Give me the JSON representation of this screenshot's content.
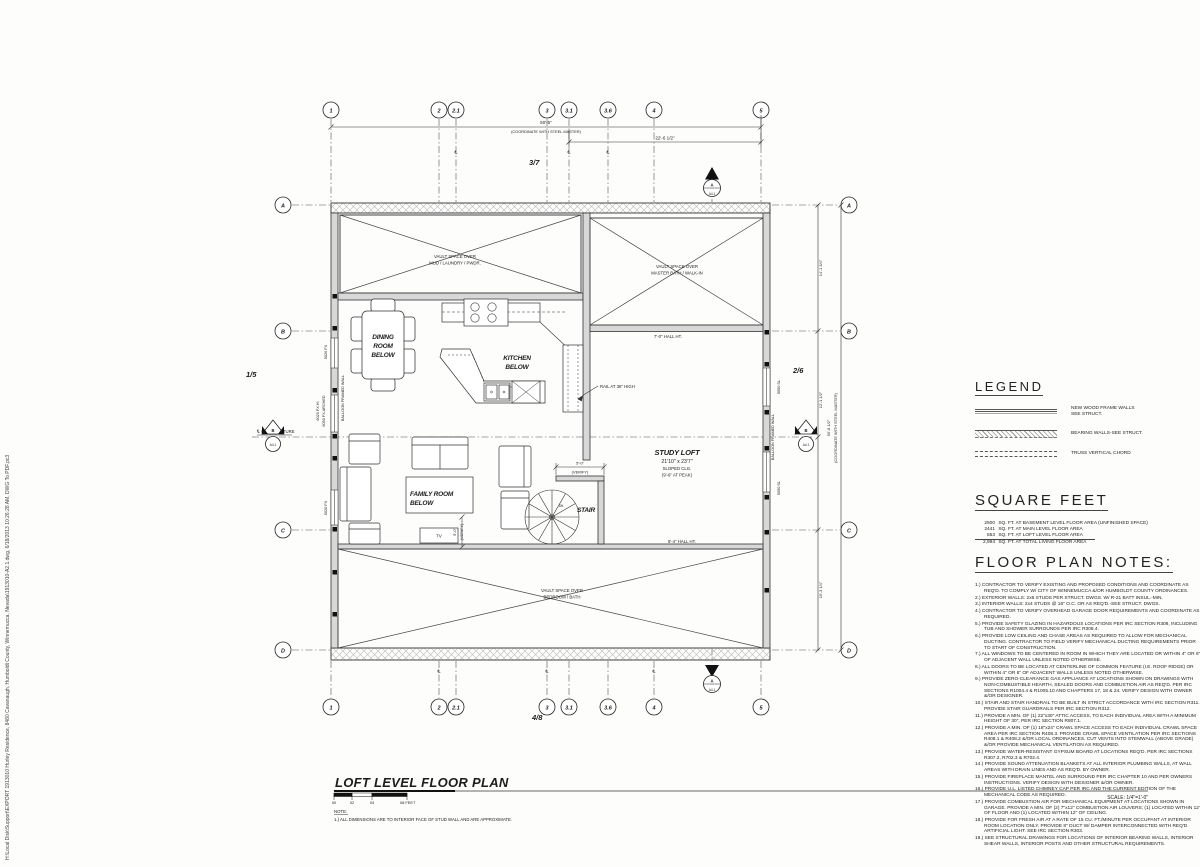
{
  "drawing": {
    "title": "LOFT LEVEL FLOOR PLAN",
    "scale_label": "SCALE: 1/4\"=1'-0\"",
    "scale_bar": [
      "00",
      "02",
      "04",
      "08 FEET"
    ],
    "note_heading": "NOTE:",
    "note_1": "1.)  ALL DIMENSIONS ARE TO INTERIOR FACE OF STUD WALL AND ARE APPROXIMATE.",
    "file_path": "H:\\Local Disk\\Support\\EXPORT 1913010 Hurley Residence, 8480 Cavanaugh, Humboldt County, Winnemucca, Nevada\\1913010-A2.1.dwg, 6/18/2013 10:26:28 AM, DWG To PDF.pc3"
  },
  "grid": {
    "columns": [
      "1",
      "2",
      "2.1",
      "3",
      "3.1",
      "3.6",
      "4",
      "5"
    ],
    "rows": [
      "A",
      "B",
      "C",
      "D"
    ]
  },
  "dims": {
    "top_total": "50'-5\"",
    "steel_note": "(COORDINATE WITH STEEL MASTER)",
    "top_partial": "22'-6 1/2\"",
    "right_total": "50'-8 1/2\"",
    "right_ab": "14'-1 3/4\"",
    "right_bc": "12'-1 1/2\"",
    "right_cd": "10'-3 1/4\"",
    "stair_w": "5'-0\"",
    "verify": "(VERIFY)",
    "cl": "℄",
    "cl_structure": "℄ OF STRUCTURE"
  },
  "refs": {
    "left": "1/5",
    "right": "2/6",
    "top": "3/7",
    "bottom": "4/8",
    "marker_a": "A",
    "marker_b": "B",
    "sheet": "A4.1"
  },
  "rooms": {
    "vault_mud": [
      "VAULT SPACE OVER",
      "MUD / LAUNDRY / PWDR."
    ],
    "vault_master": [
      "VAULT SPACE OVER",
      "MASTER BATH / WALK-IN"
    ],
    "vault_bedroom": [
      "VAULT SPACE OVER",
      "BEDROOM / BATH"
    ],
    "dining": [
      "DINING",
      "ROOM",
      "BELOW"
    ],
    "kitchen": [
      "KITCHEN",
      "BELOW"
    ],
    "family": [
      "FAMILY ROOM",
      "BELOW"
    ],
    "study": [
      "STUDY LOFT",
      "21'10\" x 23'7\"",
      "SLOPED CLG.",
      "(9'-6\" AT PEAK)"
    ],
    "stair": "STAIR",
    "dn": "DN",
    "tv": "TV",
    "hall_7": "7'-0\" HALL HT.",
    "hall_84": "8'-4\" HALL HT.",
    "rail": "RAIL AT 36\" HIGH"
  },
  "wall_tags": {
    "w5020a": "5020 FX",
    "w6020": "6020 FX HI",
    "w6050": "6050 FX ARCHED",
    "balloon_l": "BALLOON FRAMED WALL",
    "w5020b": "5020 FX",
    "w5050a": "5050 SL",
    "w5050b": "5050 SL",
    "balloon_r": "BALLOON FRAMED WALL"
  },
  "legend": {
    "heading": "LEGEND",
    "items": [
      [
        "NEW WOOD FRAME WALLS",
        "SEE STRUCT."
      ],
      [
        "BEARING WALLS-SEE STRUCT."
      ],
      [
        "TRUSS VERTICAL CHORD"
      ]
    ]
  },
  "square_feet": {
    "heading": "SQUARE FEET",
    "lines": [
      {
        "value": "2500",
        "text": "SQ. FT. AT BASEMENT LEVEL FLOOR AREA (UNFINISHED SPACE)"
      },
      {
        "value": "2441",
        "text": "SQ. FT. AT MAIN LEVEL FLOOR AREA"
      },
      {
        "value": "553",
        "text": "SQ. FT. AT LOFT LEVEL FLOOR AREA"
      },
      {
        "value": "2,994",
        "text": "SQ. FT. AT TOTAL LIVING FLOOR AREA"
      }
    ]
  },
  "notes": {
    "heading": "FLOOR PLAN NOTES:",
    "items": [
      "1.) CONTRACTOR TO VERIFY EXISTING AND PROPOSED CONDITIONS AND COORDINATE AS REQ'D. TO COMPLY W/ CITY OF WINNEMUCCA &/OR HUMBOLDT COUNTY ORDINANCES.",
      "2.) EXTERIOR WALLS: 2x6 STUDS PER STRUCT. DWGS. W/ R-21 BATT INSUL.-MIN.",
      "3.) INTERIOR WALLS: 2x4 STUDS @ 16\" O.C. OR AS REQ'D.-SEE STRUCT. DWGS.",
      "4.) CONTRACTOR TO VERIFY OVERHEAD GARAGE DOOR REQUIREMENTS AND COORDINATE AS REQUIRED.",
      "5.) PROVIDE SAFETY GLAZING IN HAZARDOUS LOCATIONS PER IRC SECTION R308, INCLUDING TUB AND SHOWER SURROUNDS PER IRC R308.4.",
      "6.) PROVIDE LOW CEILING AND CHASE AREAS AS REQUIRED TO ALLOW FOR MECHANICAL DUCTING. CONTRACTOR TO FIELD VERIFY MECHANICAL DUCTING REQUIREMENTS PRIOR TO START OF CONSTRUCTION.",
      "7.) ALL WINDOWS TO BE CENTERED IN ROOM IN WHICH THEY ARE LOCATED OR WITHIN 4\" OR 6\" OF ADJACENT WALL UNLESS NOTED OTHERWISE.",
      "8.) ALL DOORS TO BE LOCATED AT CENTERLINE OF COMMON FEATURE (I.E. ROOF RIDGE) OR WITHIN 4\" OR 6\" OF ADJACENT WALLS UNLESS NOTED OTHERWISE.",
      "9.) PROVIDE ZERO-CLEARANCE GAS APPLIANCE AT LOCATIONS SHOWN ON DRAWINGS WITH NON-COMBUSTIBLE HEARTH, SEALED DOORS AND COMBUSTION AIR AS REQ'D. PER IRC SECTIONS R1004.4 & R1005.10 AND CHAPTERS 17, 18 & 24. VERIFY DESIGN WITH OWNER &/OR DESIGNER.",
      "10.) STAIR AND STAIR HANDRAIL TO BE BUILT IN STRICT ACCORDANCE WITH IRC SECTION R311. PROVIDE STAIR GUARDRAILS PER IRC SECTION R312.",
      "11.) PROVIDE A MIN. OF (1) 22\"x30\" ATTIC ACCESS, TO EACH INDIVIDUAL AREA WITH A MINIMUM HEIGHT OF 30\", PER IRC SECTION R807.1.",
      "12.) PROVIDE A MIN. OF (1) 18\"x24\" CRAWL SPACE ACCESS TO EACH INDIVIDUAL CRAWL SPACE AREA PER IRC SECTION R408.3. PROVIDE CRAWL SPACE VENTILATION PER IRC SECTIONS R408.1 & R408.2 &/OR LOCAL ORDINANCES. CUT VENTS INTO STEMWALL (ABOVE GRADE) &/OR PROVIDE MECHANICAL VENTILATION AS REQUIRED.",
      "13.) PROVIDE WATER-RESISTANT GYPSUM BOARD AT LOCATIONS REQ'D. PER IRC SECTIONS R307.2, R702.3 & R702.4.",
      "14.) PROVIDE SOUND ATTENUATION BLANKETS AT ALL INTERIOR PLUMBING WALLS, AT WALL AREAS WITH DRAIN LINES AND AS REQ'D. BY OWNER.",
      "15.) PROVIDE FIREPLACE MANTEL AND SURROUND PER IRC CHAPTER 10 AND PER OWNERS INSTRUCTIONS. VERIFY DESIGN WITH DESIGNER &/OR OWNER.",
      "16.) PROVIDE U.L. LISTED CHIMNEY CAP PER IRC AND THE CURRENT EDITION OF THE MECHANICAL CODE AS REQUIRED.",
      "17.) PROVIDE COMBUSTION AIR FOR MECHANICAL EQUIPMENT AT LOCATIONS SHOWN IN GARAGE. PROVIDE A MIN. OF (2) 7\"x12\" COMBUSTION AIR LOUVERS; (1) LOCATED WITHIN 12\" OF FLOOR AND (1) LOCATED WITHIN 12\" OF CEILING.",
      "18.) PROVIDE FOR FRESH AIR AT A RATE OF 15 CU. FT./MINUTE PER OCCUPANT AT INTERIOR ROOM LOCATION ONLY. PROVIDE 8\" DUCT W/ DAMPER INTERCONNECTED WITH REQ'D. ARTIFICIAL LIGHT. SEE  IRC SECTION R303.",
      "19.) SEE STRUCTURAL DRAWINGS FOR LOCATIONS OF INTERIOR BEARING WALLS, INTERIOR SHEAR WALLS, INTERIOR POSTS AND OTHER STRUCTURAL REQUIREMENTS."
    ]
  }
}
